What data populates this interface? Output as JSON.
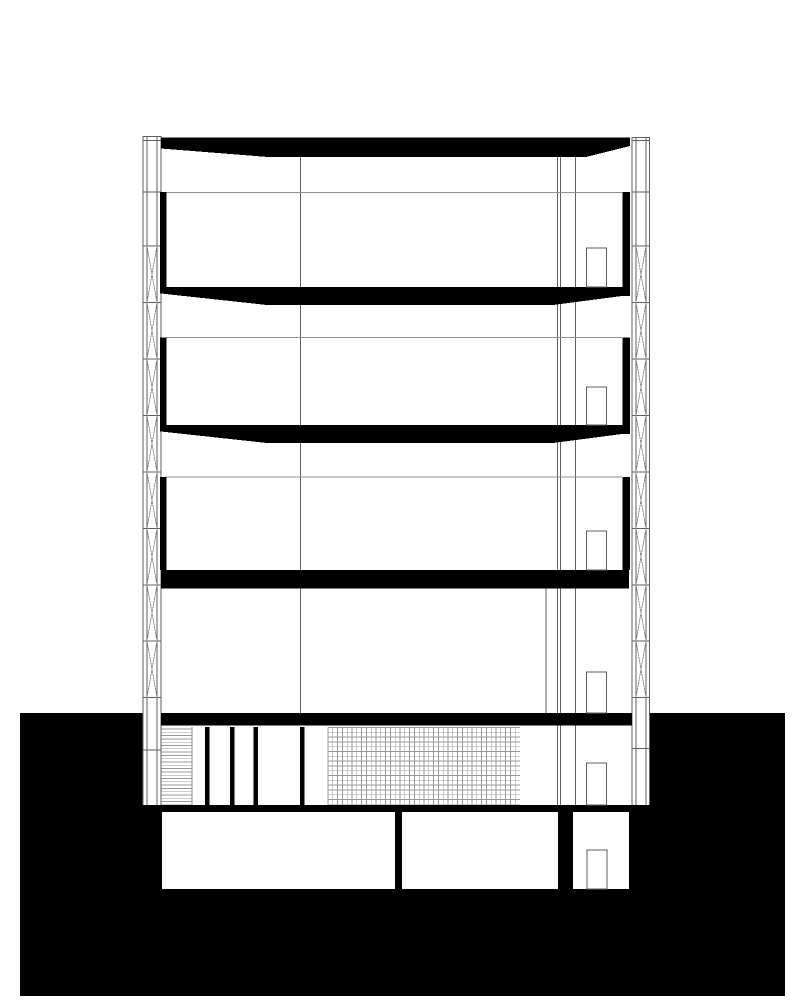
{
  "document": {
    "kind": "architectural-cross-section",
    "visible_text": []
  },
  "drawing": {
    "canvas": {
      "w": 801,
      "h": 1000
    },
    "colors": {
      "bg": "#ffffff",
      "ink": "#000000",
      "line": "#5f5f5f",
      "soft": "#8f8f8f",
      "hatch": "#989898"
    },
    "layers": [
      {
        "name": "ground-mass",
        "shapes": [
          {
            "t": "rect",
            "n": "earth-poche",
            "x": 20,
            "y": 713,
            "wd": 765,
            "h": 283,
            "f": "ink"
          }
        ]
      },
      {
        "name": "ground-cutouts",
        "shapes": [
          {
            "t": "rect",
            "n": "ground-floor-void",
            "x": 143,
            "y": 713,
            "wd": 506,
            "h": 92,
            "f": "bg"
          },
          {
            "t": "rect",
            "n": "basement-room-left",
            "x": 162,
            "y": 812,
            "wd": 233,
            "h": 77,
            "f": "bg"
          },
          {
            "t": "rect",
            "n": "basement-room-middle",
            "x": 402,
            "y": 812,
            "wd": 156,
            "h": 77,
            "f": "bg"
          },
          {
            "t": "rect",
            "n": "basement-room-right",
            "x": 573,
            "y": 812,
            "wd": 56,
            "h": 77,
            "f": "bg"
          }
        ]
      },
      {
        "name": "interior-partition-lines",
        "shapes": [
          {
            "t": "line",
            "x1": 300.7,
            "y1": 157,
            "x2": 300.7,
            "y2": 713,
            "c": "line"
          },
          {
            "t": "line",
            "x1": 557.5,
            "y1": 155,
            "x2": 557.5,
            "y2": 805,
            "c": "line"
          },
          {
            "t": "line",
            "x1": 560.5,
            "y1": 155,
            "x2": 560.5,
            "y2": 805,
            "c": "line"
          },
          {
            "t": "line",
            "x1": 575.5,
            "y1": 155,
            "x2": 575.5,
            "y2": 805,
            "c": "line"
          },
          {
            "t": "line",
            "x1": 546,
            "y1": 588,
            "x2": 546,
            "y2": 713,
            "c": "line"
          },
          {
            "t": "line",
            "x1": 161,
            "y1": 192.5,
            "x2": 622,
            "y2": 192.5,
            "c": "soft"
          },
          {
            "t": "line",
            "x1": 166,
            "y1": 337.5,
            "x2": 622,
            "y2": 337.5,
            "c": "soft"
          },
          {
            "t": "line",
            "x1": 166,
            "y1": 477,
            "x2": 622,
            "y2": 477,
            "c": "soft"
          },
          {
            "t": "line",
            "x1": 632,
            "y1": 748.7,
            "x2": 649.5,
            "y2": 748.7,
            "c": "line"
          },
          {
            "t": "line",
            "x1": 143,
            "y1": 750,
            "x2": 161,
            "y2": 750,
            "c": "line"
          },
          {
            "t": "line",
            "x1": 192,
            "y1": 727,
            "x2": 192,
            "y2": 805,
            "c": "soft"
          }
        ]
      },
      {
        "name": "floor-hatches",
        "shapes": [
          {
            "t": "hhatch",
            "n": "insulation-hatch",
            "x1": 161.5,
            "x2": 192,
            "y1": 729,
            "y2": 805,
            "step": 3.3,
            "c": "hatch",
            "sw": 0.8
          },
          {
            "t": "ghatch",
            "n": "grid-hatch",
            "x1": 328,
            "x2": 520,
            "y1": 727.5,
            "y2": 805,
            "step": 4.8,
            "c": "hatch",
            "sw": 0.8
          }
        ]
      },
      {
        "name": "facade-mullion-left",
        "shapes": [
          {
            "t": "vlines",
            "xs": [
              143,
              147,
              157,
              161
            ],
            "y1": 136,
            "y2": 805,
            "c": "line"
          },
          {
            "t": "hlines",
            "ys": [
              136.5,
              140.5,
              192,
              246,
              302.5,
              359,
              415.5,
              472,
              528.5,
              585,
              641,
              697.5
            ],
            "x1": 143,
            "x2": 161,
            "c": "line"
          },
          {
            "t": "xsegs",
            "x1": 147,
            "x2": 157,
            "segs": [
              [
                246,
                302.5
              ],
              [
                302.5,
                359
              ],
              [
                359,
                415.5
              ],
              [
                415.5,
                472
              ],
              [
                472,
                528.5
              ],
              [
                528.5,
                585
              ],
              [
                585,
                641
              ],
              [
                641,
                697.5
              ]
            ],
            "c": "soft"
          }
        ]
      },
      {
        "name": "facade-mullion-right",
        "shapes": [
          {
            "t": "vlines",
            "xs": [
              632,
              636,
              646,
              649.5
            ],
            "y1": 137,
            "y2": 805,
            "c": "line"
          },
          {
            "t": "hlines",
            "ys": [
              137.5,
              140.5,
              192,
              246,
              302.5,
              359,
              415.5,
              472,
              528.5,
              585,
              641,
              697.5
            ],
            "x1": 632,
            "x2": 649.5,
            "c": "line"
          },
          {
            "t": "xsegs",
            "x1": 636,
            "x2": 646,
            "segs": [
              [
                246,
                302.5
              ],
              [
                302.5,
                359
              ],
              [
                359,
                415.5
              ],
              [
                415.5,
                472
              ],
              [
                472,
                528.5
              ],
              [
                528.5,
                585
              ],
              [
                585,
                641
              ],
              [
                641,
                697.5
              ]
            ],
            "c": "soft"
          }
        ]
      },
      {
        "name": "cut-structure-poche",
        "shapes": [
          {
            "t": "poly",
            "n": "roof-slab",
            "pts": [
              [
                161,
                137.5
              ],
              [
                630,
                137.5
              ],
              [
                630,
                146
              ],
              [
                586,
                157
              ],
              [
                268,
                157
              ],
              [
                161,
                148.5
              ]
            ],
            "f": "ink"
          },
          {
            "t": "poly",
            "n": "floor-slab-level4",
            "pts": [
              [
                161,
                287
              ],
              [
                629,
                287
              ],
              [
                629,
                296
              ],
              [
                622,
                296
              ],
              [
                553,
                305
              ],
              [
                267,
                305
              ],
              [
                161,
                293.5
              ]
            ],
            "f": "ink"
          },
          {
            "t": "poly",
            "n": "floor-slab-level3",
            "pts": [
              [
                161,
                425
              ],
              [
                629,
                425
              ],
              [
                629,
                434
              ],
              [
                622,
                434
              ],
              [
                553,
                443
              ],
              [
                267,
                443
              ],
              [
                161,
                431.5
              ]
            ],
            "f": "ink"
          },
          {
            "t": "rect",
            "n": "floor-slab-level2",
            "x": 161,
            "y": 570,
            "wd": 468,
            "h": 18.5,
            "f": "ink"
          },
          {
            "t": "rect",
            "n": "ground-floor-ceiling-slab",
            "x": 161,
            "y": 713,
            "wd": 471,
            "h": 12.5,
            "f": "ink"
          },
          {
            "t": "rect",
            "n": "basement-ceiling-slab",
            "x": 148,
            "y": 805,
            "wd": 497,
            "h": 7,
            "f": "ink"
          },
          {
            "t": "rect",
            "n": "spandrel-left-level4",
            "x": 160,
            "y": 192,
            "wd": 6.5,
            "h": 101.5,
            "f": "ink"
          },
          {
            "t": "rect",
            "n": "spandrel-right-level4",
            "x": 622.5,
            "y": 192,
            "wd": 7.5,
            "h": 104,
            "f": "ink"
          },
          {
            "t": "rect",
            "n": "spandrel-left-level3",
            "x": 160,
            "y": 337.5,
            "wd": 6.5,
            "h": 94,
            "f": "ink"
          },
          {
            "t": "rect",
            "n": "spandrel-right-level3",
            "x": 622.5,
            "y": 337.5,
            "wd": 7.5,
            "h": 96.5,
            "f": "ink"
          },
          {
            "t": "rect",
            "n": "spandrel-left-level2",
            "x": 160,
            "y": 477,
            "wd": 6.5,
            "h": 93,
            "f": "ink"
          },
          {
            "t": "rect",
            "n": "spandrel-right-level2",
            "x": 622.5,
            "y": 477,
            "wd": 7.5,
            "h": 93,
            "f": "ink"
          },
          {
            "t": "rect",
            "n": "ground-wall-cut",
            "x": 205,
            "y": 727,
            "wd": 4.5,
            "h": 78,
            "f": "ink"
          },
          {
            "t": "rect",
            "n": "ground-wall-cut",
            "x": 230,
            "y": 727,
            "wd": 4.5,
            "h": 78,
            "f": "ink"
          },
          {
            "t": "rect",
            "n": "ground-wall-cut",
            "x": 253.5,
            "y": 727,
            "wd": 4.5,
            "h": 78,
            "f": "ink"
          },
          {
            "t": "rect",
            "n": "ground-wall-cut",
            "x": 300,
            "y": 727,
            "wd": 4.5,
            "h": 78,
            "f": "ink"
          }
        ]
      },
      {
        "name": "door-openings",
        "shapes": [
          {
            "t": "rect",
            "n": "door-opening-level5",
            "x": 586.5,
            "y": 248,
            "wd": 20,
            "h": 39,
            "f": "bg",
            "sk": "line"
          },
          {
            "t": "rect",
            "n": "door-opening-level4",
            "x": 586.5,
            "y": 387,
            "wd": 20,
            "h": 38,
            "f": "bg",
            "sk": "line"
          },
          {
            "t": "rect",
            "n": "door-opening-level3",
            "x": 586.5,
            "y": 531,
            "wd": 20,
            "h": 39,
            "f": "bg",
            "sk": "line"
          },
          {
            "t": "rect",
            "n": "door-opening-level2",
            "x": 586.5,
            "y": 672,
            "wd": 20,
            "h": 41,
            "f": "bg",
            "sk": "line"
          },
          {
            "t": "rect",
            "n": "door-opening-ground",
            "x": 586.5,
            "y": 763,
            "wd": 20,
            "h": 42,
            "f": "bg",
            "sk": "line"
          },
          {
            "t": "rect",
            "n": "door-opening-basement",
            "x": 587,
            "y": 850,
            "wd": 20,
            "h": 39,
            "f": "bg",
            "sk": "line"
          }
        ]
      }
    ]
  }
}
